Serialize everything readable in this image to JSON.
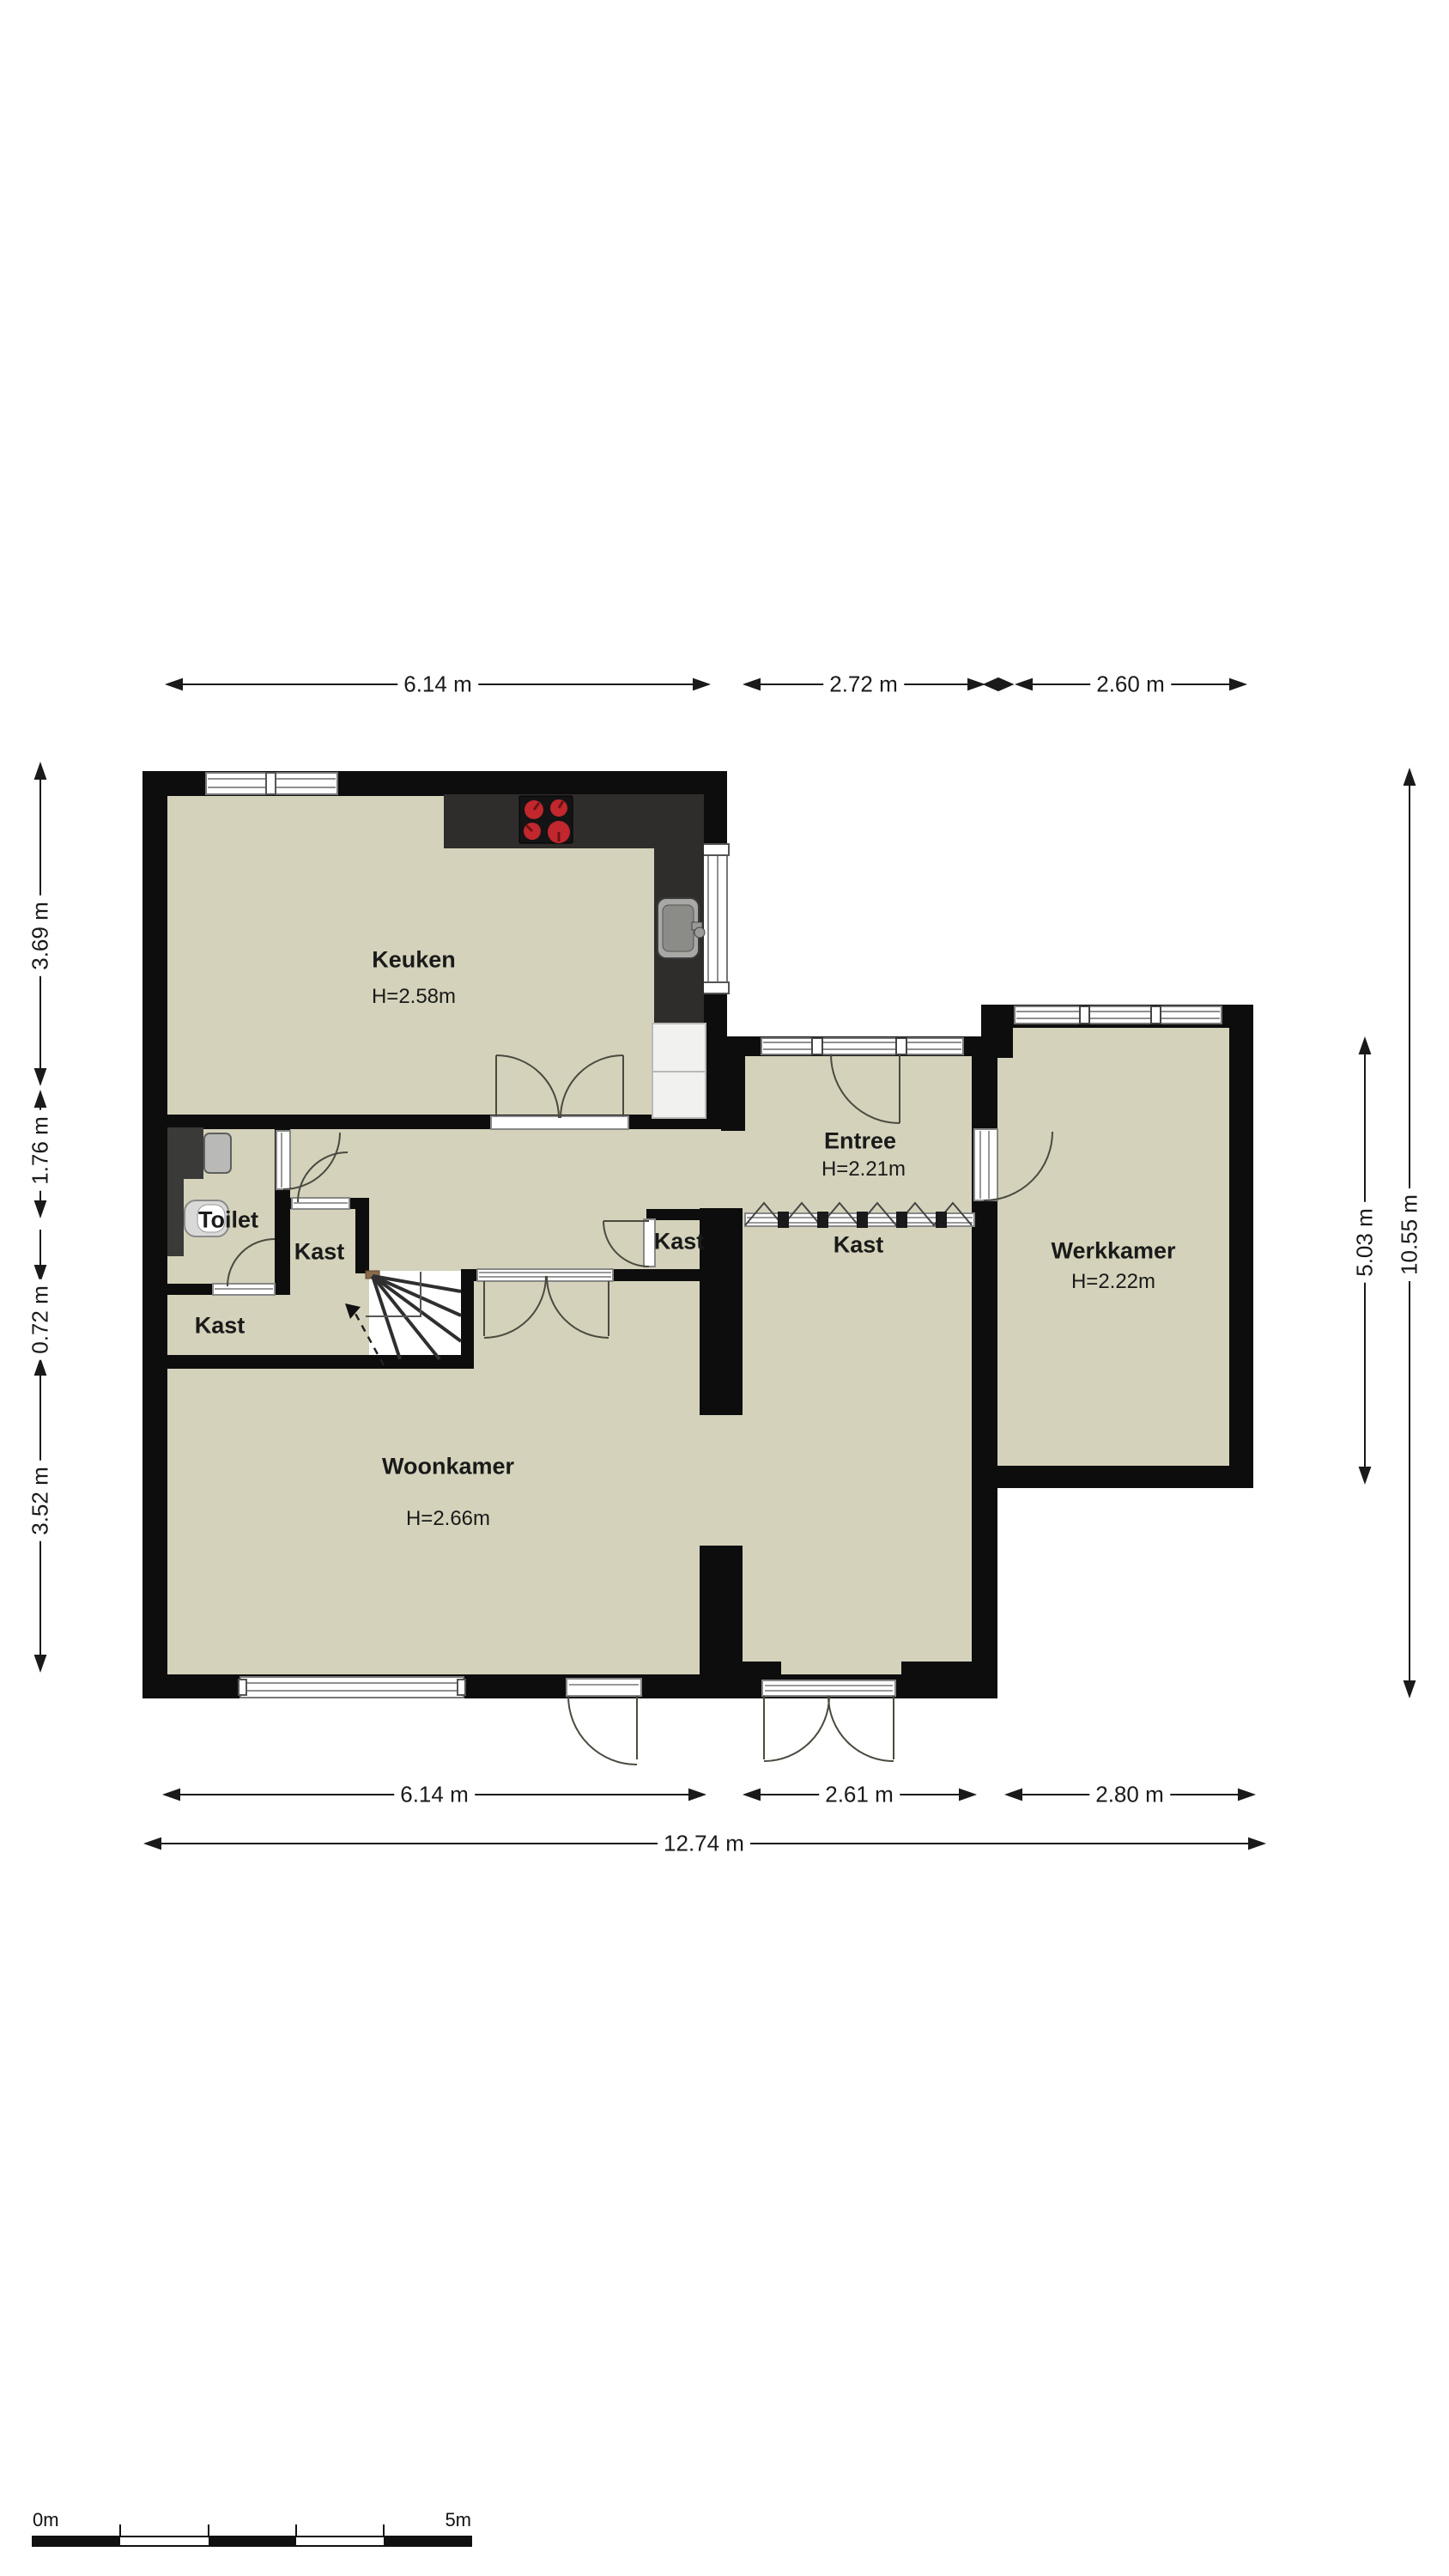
{
  "rooms": {
    "keuken": {
      "name": "Keuken",
      "height": "H=2.58m"
    },
    "entree": {
      "name": "Entree",
      "height": "H=2.21m"
    },
    "werkkamer": {
      "name": "Werkkamer",
      "height": "H=2.22m"
    },
    "woonkamer": {
      "name": "Woonkamer",
      "height": "H=2.66m"
    },
    "toilet": {
      "name": "Toilet"
    },
    "kast_hal": {
      "name": "Kast"
    },
    "kast_trap": {
      "name": "Kast"
    },
    "kast_gang": {
      "name": "Kast"
    },
    "kast_entree": {
      "name": "Kast"
    }
  },
  "dimensions": {
    "top": [
      "6.14 m",
      "2.72 m",
      "2.60 m"
    ],
    "bottom": [
      "6.14 m",
      "2.61 m",
      "2.80 m"
    ],
    "total": "12.74 m",
    "left": [
      "3.69 m",
      "1.76 m",
      "0.72 m",
      "3.52 m"
    ],
    "right": [
      "5.03 m",
      "10.55 m"
    ]
  },
  "scale_bar": {
    "start": "0m",
    "end": "5m"
  },
  "colors": {
    "floor": "#d4d2ba",
    "wall": "#0d0d0d",
    "counter": "#2e2d2b",
    "burner_red": "#c1272d",
    "newel_brown": "#8a6a49",
    "background": "#ffffff"
  }
}
